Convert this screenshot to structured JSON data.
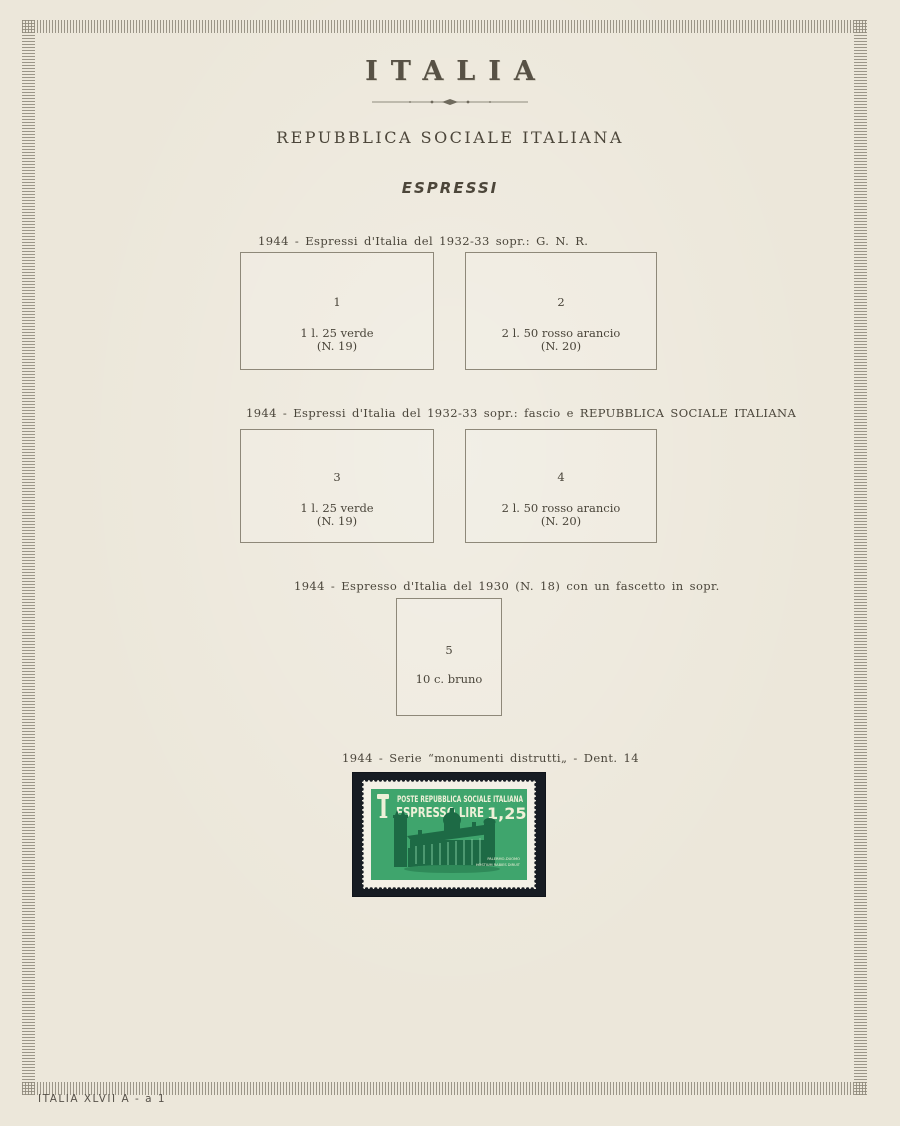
{
  "page": {
    "title": "ITALIA",
    "subtitle": "REPUBBLICA SOCIALE ITALIANA",
    "series": "ESPRESSI",
    "footer": "ITALIA XLVII A - a 1"
  },
  "colors": {
    "paper": "#ece7da",
    "border_band": "#8d8779",
    "ink": "#4a453a",
    "stamp_mount": "#171c23",
    "stamp_paper": "#f3f0e6",
    "stamp_green": "#3fa56d",
    "stamp_dark_green": "#1d6a45",
    "stamp_lettering": "#eef0d8"
  },
  "sections": [
    {
      "heading": "1944 - Espressi d'Italia del 1932-33 sopr.: G. N. R.",
      "boxes": [
        {
          "number": "1",
          "line1": "1 l. 25 verde",
          "line2": "(N. 19)"
        },
        {
          "number": "2",
          "line1": "2 l. 50 rosso arancio",
          "line2": "(N. 20)"
        }
      ]
    },
    {
      "heading": "1944 - Espressi d'Italia del 1932-33 sopr.: fascio e REPUBBLICA SOCIALE ITALIANA",
      "boxes": [
        {
          "number": "3",
          "line1": "1 l. 25 verde",
          "line2": "(N. 19)"
        },
        {
          "number": "4",
          "line1": "2 l. 50 rosso arancio",
          "line2": "(N. 20)"
        }
      ]
    },
    {
      "heading": "1944 - Espresso d'Italia del 1930 (N. 18) con un fascetto in sopr.",
      "boxes": [
        {
          "number": "5",
          "line1": "10 c. bruno",
          "line2": ""
        }
      ]
    },
    {
      "heading": "1944 - Serie “monumenti distrutti„ - Dent. 14"
    }
  ],
  "stamp": {
    "line1": "POSTE REPUBBLICA SOCIALE ITALIANA",
    "line2": "ESPRESSO LIRE",
    "value": "1,25",
    "caption1": "PALERMO-DUOMO",
    "caption2": "HOSTIUM RABIES DIRUIT"
  }
}
